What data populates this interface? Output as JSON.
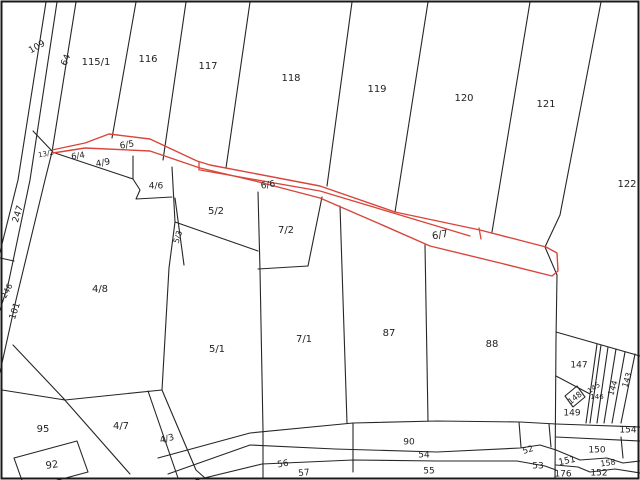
{
  "map": {
    "type": "cadastral-parcel-map",
    "colors": {
      "background": "#ffffff",
      "boundary_line": "#262626",
      "highlight_line": "#d9453a",
      "label_text": "#1f1f1f",
      "frame": "#1a1a1a"
    },
    "highlighted_parcels": [
      "6/5",
      "6/6",
      "6/7"
    ],
    "labels": [
      {
        "text": "109",
        "x": 37,
        "y": 47,
        "rot": -30,
        "size": 9
      },
      {
        "text": "64",
        "x": 66,
        "y": 60,
        "rot": -68,
        "size": 9
      },
      {
        "text": "115/1",
        "x": 96,
        "y": 62,
        "rot": 0,
        "size": 10
      },
      {
        "text": "116",
        "x": 148,
        "y": 59,
        "rot": 0,
        "size": 10
      },
      {
        "text": "117",
        "x": 208,
        "y": 66,
        "rot": 0,
        "size": 10
      },
      {
        "text": "118",
        "x": 291,
        "y": 78,
        "rot": 0,
        "size": 10
      },
      {
        "text": "119",
        "x": 377,
        "y": 89,
        "rot": 0,
        "size": 10
      },
      {
        "text": "120",
        "x": 464,
        "y": 98,
        "rot": 0,
        "size": 10
      },
      {
        "text": "121",
        "x": 546,
        "y": 104,
        "rot": 0,
        "size": 10
      },
      {
        "text": "122",
        "x": 627,
        "y": 184,
        "rot": 0,
        "size": 10
      },
      {
        "text": "13/2",
        "x": 46,
        "y": 154,
        "rot": -10,
        "size": 7
      },
      {
        "text": "6/4",
        "x": 78,
        "y": 156,
        "rot": -8,
        "size": 8.5
      },
      {
        "text": "6/5",
        "x": 127,
        "y": 145,
        "rot": -10,
        "size": 9
      },
      {
        "text": "4/9",
        "x": 103,
        "y": 163,
        "rot": -12,
        "size": 9
      },
      {
        "text": "4/6",
        "x": 156,
        "y": 186,
        "rot": 0,
        "size": 9
      },
      {
        "text": "6/6",
        "x": 268,
        "y": 185,
        "rot": -10,
        "size": 9
      },
      {
        "text": "5/2",
        "x": 216,
        "y": 211,
        "rot": 0,
        "size": 10
      },
      {
        "text": "7/2",
        "x": 286,
        "y": 230,
        "rot": 0,
        "size": 10
      },
      {
        "text": "5/3",
        "x": 178,
        "y": 237,
        "rot": -72,
        "size": 8
      },
      {
        "text": "6/7",
        "x": 440,
        "y": 235,
        "rot": -10,
        "size": 10
      },
      {
        "text": "247",
        "x": 18,
        "y": 214,
        "rot": -72,
        "size": 9
      },
      {
        "text": "246",
        "x": 7,
        "y": 291,
        "rot": -62,
        "size": 8
      },
      {
        "text": "101",
        "x": 15,
        "y": 311,
        "rot": -72,
        "size": 9
      },
      {
        "text": "4/8",
        "x": 100,
        "y": 289,
        "rot": 0,
        "size": 10
      },
      {
        "text": "5/1",
        "x": 217,
        "y": 349,
        "rot": 0,
        "size": 10
      },
      {
        "text": "7/1",
        "x": 304,
        "y": 339,
        "rot": 0,
        "size": 10
      },
      {
        "text": "87",
        "x": 389,
        "y": 333,
        "rot": 0,
        "size": 10
      },
      {
        "text": "88",
        "x": 492,
        "y": 344,
        "rot": 0,
        "size": 10
      },
      {
        "text": "95",
        "x": 43,
        "y": 429,
        "rot": 0,
        "size": 10
      },
      {
        "text": "4/7",
        "x": 121,
        "y": 426,
        "rot": 0,
        "size": 10
      },
      {
        "text": "4/3",
        "x": 167,
        "y": 439,
        "rot": -15,
        "size": 9
      },
      {
        "text": "92",
        "x": 52,
        "y": 465,
        "rot": -8,
        "size": 10
      },
      {
        "text": "90",
        "x": 409,
        "y": 442,
        "rot": 0,
        "size": 9
      },
      {
        "text": "54",
        "x": 424,
        "y": 455,
        "rot": 0,
        "size": 9
      },
      {
        "text": "56",
        "x": 283,
        "y": 464,
        "rot": -10,
        "size": 9
      },
      {
        "text": "57",
        "x": 304,
        "y": 473,
        "rot": -6,
        "size": 9
      },
      {
        "text": "55",
        "x": 429,
        "y": 471,
        "rot": 0,
        "size": 9
      },
      {
        "text": "52",
        "x": 528,
        "y": 450,
        "rot": -18,
        "size": 8.5
      },
      {
        "text": "53",
        "x": 538,
        "y": 466,
        "rot": 0,
        "size": 9
      },
      {
        "text": "147",
        "x": 579,
        "y": 365,
        "rot": 0,
        "size": 9
      },
      {
        "text": "148",
        "x": 575,
        "y": 398,
        "rot": -38,
        "size": 8
      },
      {
        "text": "149",
        "x": 572,
        "y": 413,
        "rot": 0,
        "size": 9
      },
      {
        "text": "145",
        "x": 594,
        "y": 388,
        "rot": -35,
        "size": 7
      },
      {
        "text": "146",
        "x": 597,
        "y": 397,
        "rot": 0,
        "size": 7
      },
      {
        "text": "144",
        "x": 613,
        "y": 388,
        "rot": -72,
        "size": 8
      },
      {
        "text": "143",
        "x": 627,
        "y": 380,
        "rot": -72,
        "size": 8
      },
      {
        "text": "154",
        "x": 628,
        "y": 430,
        "rot": 0,
        "size": 9
      },
      {
        "text": "150",
        "x": 597,
        "y": 450,
        "rot": 0,
        "size": 9
      },
      {
        "text": "151",
        "x": 567,
        "y": 461,
        "rot": -12,
        "size": 9
      },
      {
        "text": "176",
        "x": 563,
        "y": 474,
        "rot": 0,
        "size": 9
      },
      {
        "text": "158",
        "x": 608,
        "y": 463,
        "rot": -8,
        "size": 8
      },
      {
        "text": "152",
        "x": 599,
        "y": 473,
        "rot": 0,
        "size": 9
      }
    ]
  }
}
